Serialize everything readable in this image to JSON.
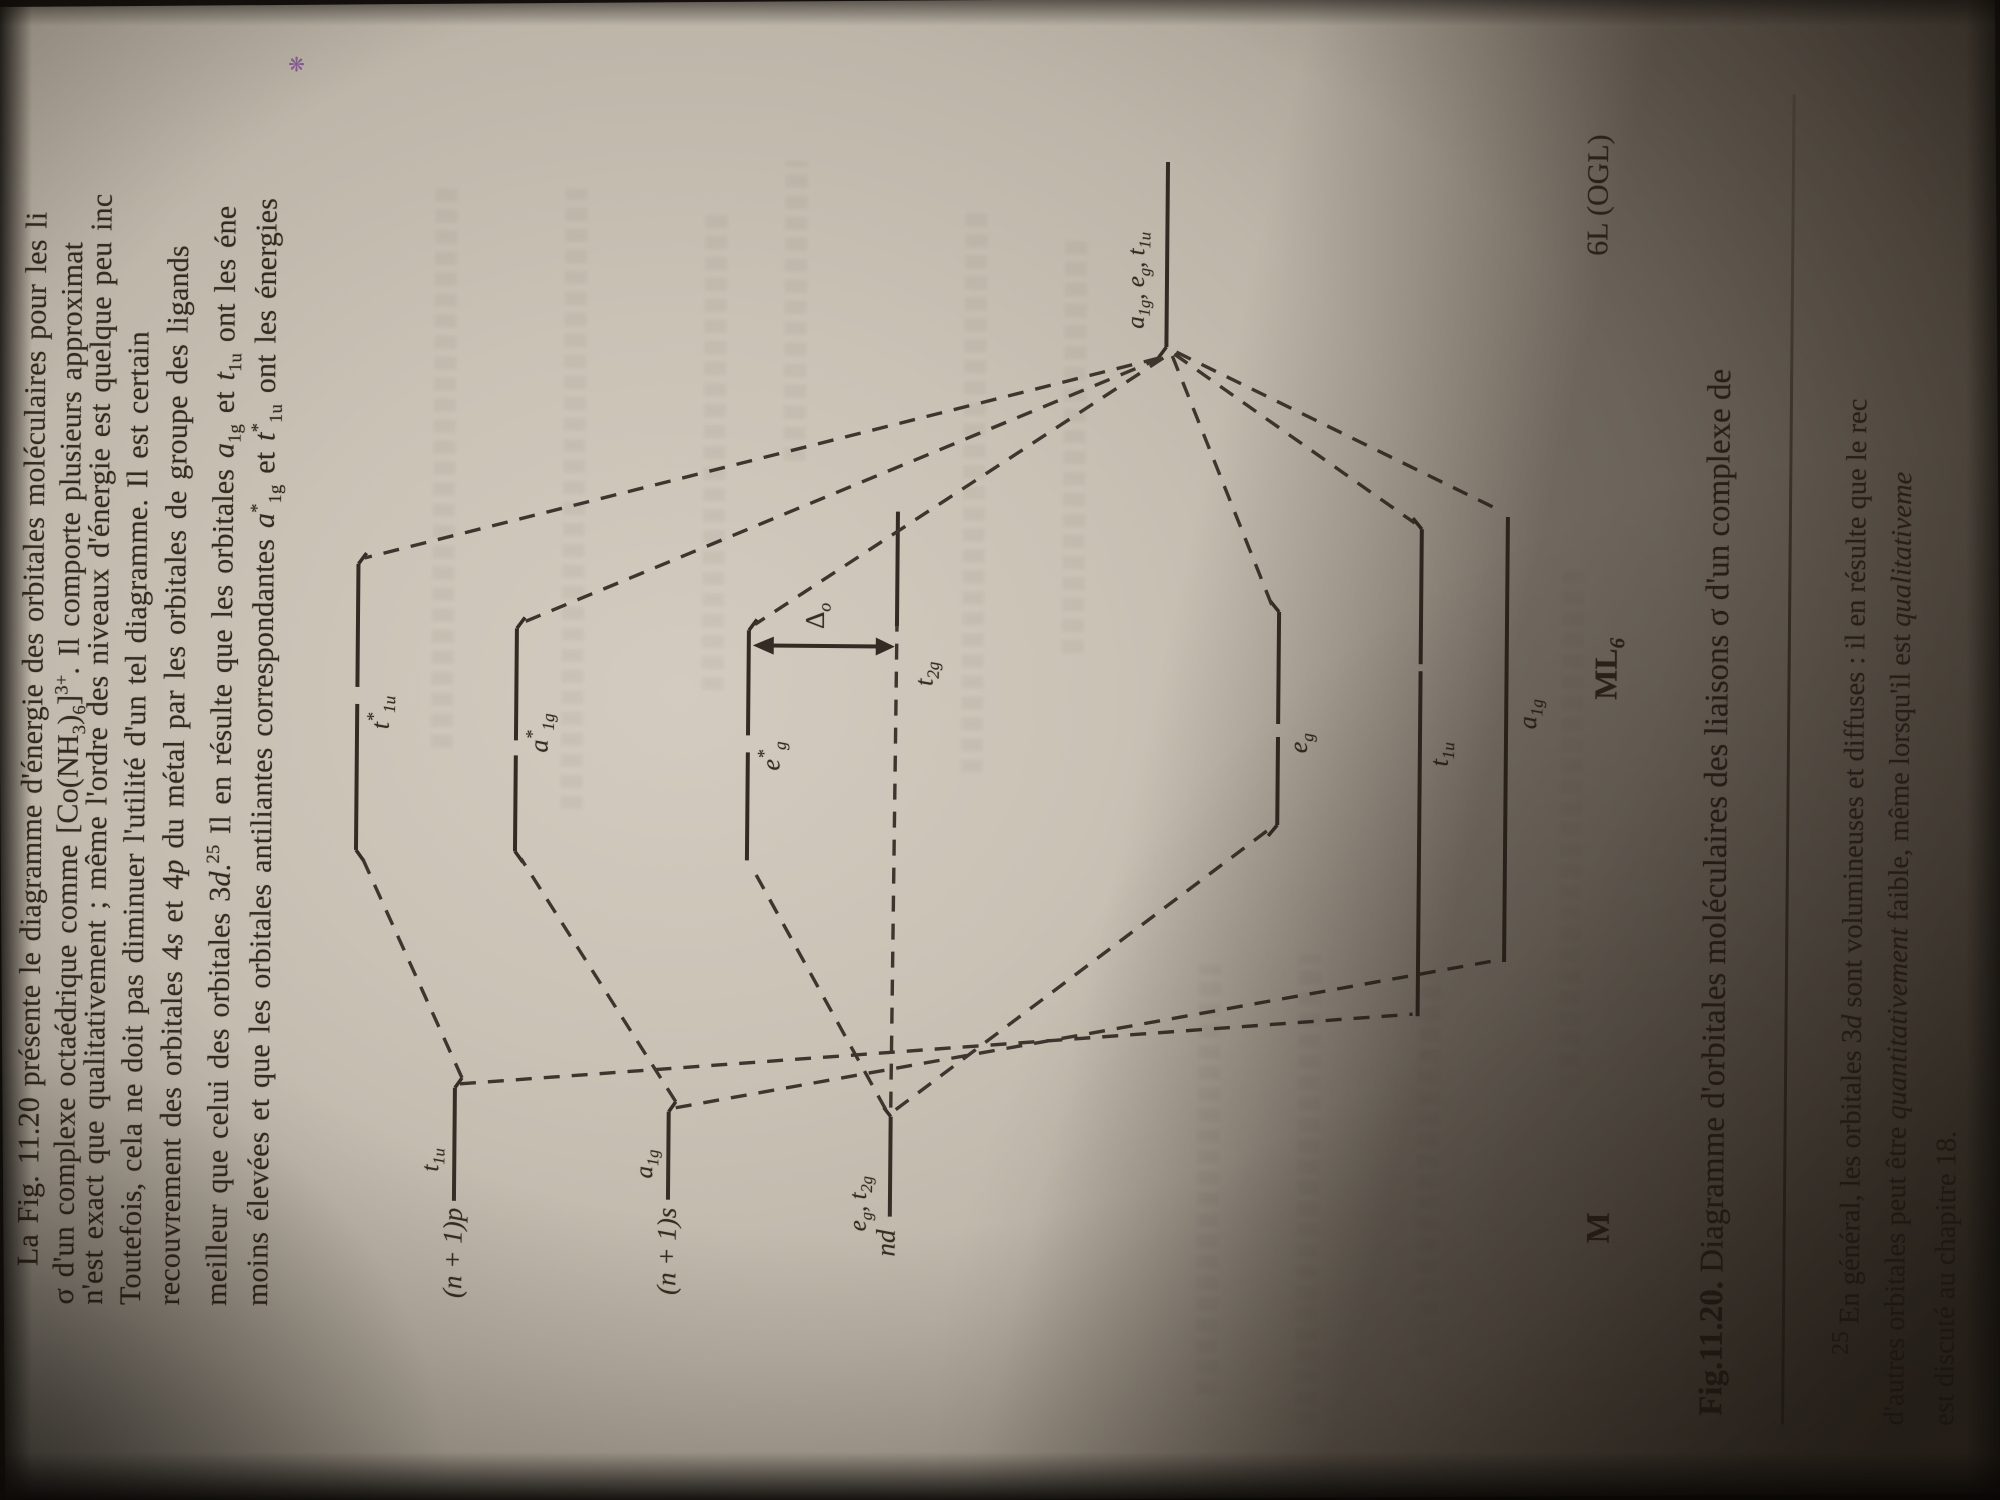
{
  "paragraph": {
    "lines": [
      "La Fig. 11.20 présente le diagramme d'énergie des orbitales moléculaires pour les li",
      "σ d'un complexe octaédrique comme [Co(NH_{3})_{6}]^{3+}. Il comporte plusieurs approximat",
      "n'est exact que qualitativement ; même l'ordre des niveaux d'énergie est quelque peu inc",
      "Toutefois, cela ne doit pas diminuer l'utilité d'un tel diagramme. Il est certain",
      "recouvrement des orbitales 4~s~ et 4~p~ du métal par les orbitales de groupe des ligands",
      "meilleur que celui des orbitales 3~d~.^{25} Il en résulte que les orbitales ~a~_{1g} et ~t~_{1u} ont les éne",
      "moins élevées et que les orbitales antiliantes correspondantes ~a~^{*}_{1g} et ~t~^{*}_{1u} ont les énergies"
    ]
  },
  "diagram": {
    "metal": {
      "p_label": "(~n~ + 1)~p~",
      "p_sym": "~t~_{1u}",
      "s_label": "(~n~ + 1)~s~",
      "s_sym": "~a~_{1g}",
      "d_label": "~nd~",
      "d_sym": "~e~_{g}, ~t~_{2g}"
    },
    "mo": {
      "t1u_star": "~t~^{*}_{1u}",
      "a1g_star": "~a~^{*}_{1g}",
      "eg_star": "~e~^{*}_{g}",
      "t2g": "~t~_{2g}",
      "eg": "~e~_{g}",
      "t1u": "~t~_{1u}",
      "a1g": "~a~_{1g}"
    },
    "ligand_sym": "~a~_{1g}, ~e~_{g}, ~t~_{1u}",
    "delta_label": "Δ_{~o~}",
    "bottom": {
      "metal": "M",
      "complex": "ML_{6}",
      "ligand": "6L (OGL)"
    }
  },
  "caption": {
    "fig": "Fig.11.20.",
    "text": " Diagramme d'orbitales moléculaires des liaisons σ d'un complexe de"
  },
  "footnote": {
    "lines": [
      "^{25} En général, les orbitales 3~d~ sont volumineuses et diffuses : il en résulte que le rec",
      "d'autres orbitales peut être ~quantitativement~ faible, même lorsqu'il est ~qualitativeme~",
      "est discuté au chapitre 18."
    ]
  },
  "margin_mark": "❋",
  "colors": {
    "ink": "#33291e",
    "paper": "#c7bfb2",
    "shadow": "#1e1711"
  }
}
